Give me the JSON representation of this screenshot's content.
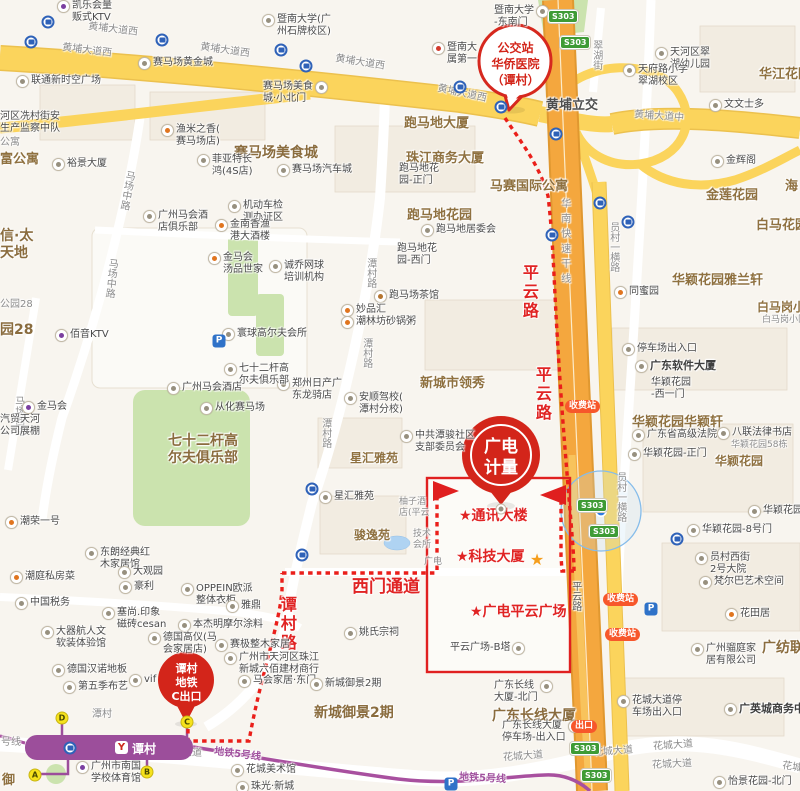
{
  "colors": {
    "route_red": "#EA1F1A",
    "box_red": "#E02020",
    "balloon_red": "#D3251A",
    "road_yellow": "#FBD45C",
    "highway_orange": "#F4A73E",
    "metro_purple": "#9C4E9B",
    "green": "#CBE3AE",
    "exit_yellow": "#F6E21C",
    "shield_green": "#3E9B35",
    "pill_orange": "#F7572B",
    "bus_blue": "#2F62B8",
    "location_blue": "#2E7BE0"
  },
  "callouts": {
    "bus": {
      "lines": [
        "公交站",
        "华侨医院",
        "（谭村）"
      ]
    },
    "dest": {
      "lines": [
        "广电",
        "计量"
      ]
    },
    "exit": {
      "lines": [
        "谭村",
        "地铁",
        "C出口"
      ]
    }
  },
  "station": {
    "name": "谭村",
    "logo": "Y"
  },
  "map": {
    "labels": [
      {
        "t": "黄埔大道西",
        "x": 88,
        "y": 24,
        "c": "road",
        "rot": 7
      },
      {
        "t": "黄埔大道西",
        "x": 62,
        "y": 45,
        "c": "road",
        "rot": 7
      },
      {
        "t": "黄埔大道西",
        "x": 200,
        "y": 45,
        "c": "road",
        "rot": 8
      },
      {
        "t": "黄埔大道西",
        "x": 335,
        "y": 57,
        "c": "road",
        "rot": 9
      },
      {
        "t": "黄埔大道西",
        "x": 437,
        "y": 88,
        "c": "road",
        "rot": 12
      },
      {
        "t": "黄埔大道中",
        "x": 634,
        "y": 111,
        "c": "road",
        "rot": 4
      },
      {
        "t": "黄埔立交",
        "x": 546,
        "y": 98,
        "c": "roadb"
      },
      {
        "t": "翠湖街",
        "x": 590,
        "y": 40,
        "c": "road",
        "v": 1
      },
      {
        "t": "华南快速干线",
        "x": 558,
        "y": 198,
        "c": "road vsp",
        "v": 1
      },
      {
        "t": "员村一横路",
        "x": 607,
        "y": 222,
        "c": "road",
        "v": 1
      },
      {
        "t": "员村一横路",
        "x": 614,
        "y": 472,
        "c": "road",
        "v": 1
      },
      {
        "t": "潭村路",
        "x": 364,
        "y": 258,
        "c": "road",
        "v": 1
      },
      {
        "t": "潭村路",
        "x": 360,
        "y": 338,
        "c": "road",
        "v": 1
      },
      {
        "t": "潭村路",
        "x": 319,
        "y": 418,
        "c": "road",
        "v": 1
      },
      {
        "t": "马场中路",
        "x": 120,
        "y": 170,
        "c": "road",
        "v": 1,
        "rot": 10
      },
      {
        "t": "马场中路",
        "x": 104,
        "y": 258,
        "c": "road",
        "v": 1,
        "rot": 6
      },
      {
        "t": "马场西路",
        "x": 12,
        "y": 396,
        "c": "road",
        "v": 1
      },
      {
        "t": "平云路",
        "x": 569,
        "y": 581,
        "c": "roaddk",
        "v": 1
      },
      {
        "t": "花城大道",
        "x": 162,
        "y": 747,
        "c": "road",
        "rot": 3
      },
      {
        "t": "花城大道",
        "x": 503,
        "y": 751,
        "c": "road",
        "rot": -4
      },
      {
        "t": "花城大道",
        "x": 593,
        "y": 746,
        "c": "road",
        "rot": -4
      },
      {
        "t": "花城大道",
        "x": 653,
        "y": 740,
        "c": "road",
        "rot": -4
      },
      {
        "t": "花城大道",
        "x": 652,
        "y": 759,
        "c": "road",
        "rot": -3
      },
      {
        "t": "花城大道",
        "x": 782,
        "y": 763,
        "c": "road",
        "rot": 8
      },
      {
        "t": "地铁5号线",
        "x": 214,
        "y": 749,
        "c": "purple",
        "rot": 7
      },
      {
        "t": "地铁5号线",
        "x": 459,
        "y": 773,
        "c": "purple",
        "rot": 3
      },
      {
        "t": "号线",
        "x": 1,
        "y": 737,
        "c": "road"
      },
      {
        "t": "潭村",
        "x": 92,
        "y": 709,
        "c": "g"
      },
      {
        "t": "平云路",
        "x": 519,
        "y": 264,
        "c": "red16",
        "v": 1
      },
      {
        "t": "平云路",
        "x": 532,
        "y": 366,
        "c": "red16",
        "v": 1
      },
      {
        "t": "谭村路",
        "x": 277,
        "y": 596,
        "c": "red16",
        "v": 1
      },
      {
        "t": "西门通道",
        "x": 352,
        "y": 577,
        "c": "red17"
      },
      {
        "t": "★通讯大楼",
        "x": 459,
        "y": 508,
        "c": "red15"
      },
      {
        "t": "★科技大厦",
        "x": 456,
        "y": 549,
        "c": "red15"
      },
      {
        "t": "★广电平云广场",
        "x": 470,
        "y": 604,
        "c": "red15"
      },
      {
        "t": "赛马场美食城",
        "x": 234,
        "y": 145,
        "c": "a14"
      },
      {
        "t": "跑马地大厦",
        "x": 404,
        "y": 116,
        "c": "a13"
      },
      {
        "t": "珠江商务大厦",
        "x": 406,
        "y": 151,
        "c": "a13"
      },
      {
        "t": "跑马地花园",
        "x": 407,
        "y": 208,
        "c": "a13"
      },
      {
        "t": "马赛国际公寓",
        "x": 490,
        "y": 179,
        "c": "a13"
      },
      {
        "t": "金莲花园",
        "x": 706,
        "y": 188,
        "c": "a13"
      },
      {
        "t": "白马花园",
        "x": 756,
        "y": 218,
        "c": "a13"
      },
      {
        "t": "华江花园",
        "x": 759,
        "y": 67,
        "c": "a13"
      },
      {
        "t": "白马岗小区",
        "x": 757,
        "y": 300,
        "c": "area"
      },
      {
        "t": "白马岗小区",
        "x": 762,
        "y": 315,
        "c": "g9"
      },
      {
        "t": "华颖花园雅兰轩",
        "x": 672,
        "y": 273,
        "c": "a13"
      },
      {
        "t": "华颖花园华颖轩",
        "x": 632,
        "y": 415,
        "c": "a13"
      },
      {
        "t": "华颖花园",
        "x": 715,
        "y": 454,
        "c": "area"
      },
      {
        "t": "新城市领秀",
        "x": 420,
        "y": 376,
        "c": "a13"
      },
      {
        "t": "星汇雅苑",
        "x": 350,
        "y": 451,
        "c": "area"
      },
      {
        "t": "骏逸苑",
        "x": 354,
        "y": 528,
        "c": "area"
      },
      {
        "t": "七十二杆高\n尔夫俱乐部",
        "x": 168,
        "y": 433,
        "c": "a14"
      },
      {
        "t": "新城御景2期",
        "x": 314,
        "y": 705,
        "c": "a14"
      },
      {
        "t": "广东长线大厦",
        "x": 492,
        "y": 708,
        "c": "a14"
      },
      {
        "t": "富公寓",
        "x": 0,
        "y": 152,
        "c": "a13"
      },
      {
        "t": "信·太\n天地",
        "x": 0,
        "y": 228,
        "c": "a14"
      },
      {
        "t": "园28",
        "x": 0,
        "y": 322,
        "c": "a14"
      },
      {
        "t": "公园28",
        "x": 0,
        "y": 299,
        "c": "g"
      },
      {
        "t": "海",
        "x": 785,
        "y": 179,
        "c": "a13"
      },
      {
        "t": "广纺联",
        "x": 762,
        "y": 640,
        "c": "a14"
      },
      {
        "t": "公寓",
        "x": 0,
        "y": 137,
        "c": "g"
      },
      {
        "t": "御",
        "x": 2,
        "y": 773,
        "c": "a13"
      },
      {
        "t": "凯乐会量\n贩式KTV",
        "x": 57,
        "y": 0,
        "i": "#7B3FA0"
      },
      {
        "t": "联通新时空广场",
        "x": 16,
        "y": 75,
        "i": 1
      },
      {
        "t": "裕景大厦",
        "x": 52,
        "y": 158,
        "i": 1
      },
      {
        "t": "赛马场黄金城",
        "x": 138,
        "y": 57,
        "i": 1
      },
      {
        "t": "渔米之香(\n赛马场店)",
        "x": 161,
        "y": 124,
        "i": "#E0751F"
      },
      {
        "t": "菲亚特长\n鸿(4S店)",
        "x": 197,
        "y": 154,
        "i": 1
      },
      {
        "t": "赛马场汽车城",
        "x": 277,
        "y": 164,
        "i": 1
      },
      {
        "t": "赛马场美食\n城·小北门",
        "x": 263,
        "y": 81,
        "ir": 1
      },
      {
        "t": "暨南大学(广\n州石牌校区)",
        "x": 262,
        "y": 14,
        "i": 1
      },
      {
        "t": "暨南大学\n-东南门",
        "x": 494,
        "y": 5,
        "ir": 1
      },
      {
        "t": "暨南大\n属第一",
        "x": 432,
        "y": 42,
        "i": "#D33A2C"
      },
      {
        "t": "河区冼村街安\n生产监察中队",
        "x": 0,
        "y": 111
      },
      {
        "t": "机动车检\n测办证区",
        "x": 228,
        "y": 200,
        "i": 1
      },
      {
        "t": "金南香渔\n港大酒楼",
        "x": 215,
        "y": 219,
        "i": "#E0751F"
      },
      {
        "t": "金马会\n汤品世家",
        "x": 208,
        "y": 252,
        "i": "#E0751F"
      },
      {
        "t": "诚乔网球\n培训机构",
        "x": 269,
        "y": 260,
        "i": 1
      },
      {
        "t": "广州马会酒\n店俱乐部",
        "x": 143,
        "y": 210,
        "i": 1
      },
      {
        "t": "天河区翠\n湖幼儿园",
        "x": 655,
        "y": 47,
        "i": 1
      },
      {
        "t": "天府路小学\n翠湖校区",
        "x": 623,
        "y": 64,
        "i": 1
      },
      {
        "t": "文文士多",
        "x": 709,
        "y": 99,
        "i": 1
      },
      {
        "t": "金辉阁",
        "x": 711,
        "y": 155,
        "i": 1
      },
      {
        "t": "同蜜园",
        "x": 614,
        "y": 286,
        "i": "#E0751F"
      },
      {
        "t": "跑马地居委会",
        "x": 421,
        "y": 224,
        "i": 1
      },
      {
        "t": "跑马地花\n园-西门",
        "x": 397,
        "y": 243
      },
      {
        "t": "跑马地花\n园-正门",
        "x": 399,
        "y": 163
      },
      {
        "t": "跑马场茶馆",
        "x": 374,
        "y": 290,
        "i": "#B5752F"
      },
      {
        "t": "妙品汇",
        "x": 341,
        "y": 304,
        "i": "#E0751F"
      },
      {
        "t": "潮林坊砂锅粥",
        "x": 341,
        "y": 316,
        "i": "#E0751F"
      },
      {
        "t": "郑州日产广\n东龙骑店",
        "x": 277,
        "y": 378,
        "i": 1
      },
      {
        "t": "安顺驾校(\n潭村分校)",
        "x": 344,
        "y": 392,
        "i": 1
      },
      {
        "t": "中共潭骏社区\n支部委员会",
        "x": 400,
        "y": 430,
        "i": 1
      },
      {
        "t": "星汇雅苑",
        "x": 319,
        "y": 491,
        "i": 1
      },
      {
        "t": "柚子酒\n店(平云",
        "x": 399,
        "y": 497,
        "c": "g9"
      },
      {
        "t": "技术\n会所",
        "x": 413,
        "y": 529,
        "c": "g9"
      },
      {
        "t": "广电",
        "x": 424,
        "y": 557,
        "c": "g9"
      },
      {
        "t": "寰球高尔夫会所",
        "x": 222,
        "y": 328,
        "i": 1
      },
      {
        "t": "从化赛马场",
        "x": 200,
        "y": 402,
        "i": 1
      },
      {
        "t": "七十二杆高\n尔夫俱乐部",
        "x": 224,
        "y": 363,
        "i": 1
      },
      {
        "t": "广州马会酒店",
        "x": 167,
        "y": 382,
        "i": 1
      },
      {
        "t": "汽贸天河\n公司展棚",
        "x": 0,
        "y": 414
      },
      {
        "t": "金马会",
        "x": 22,
        "y": 401,
        "i": "#7B3FA0"
      },
      {
        "t": "佰音KTV",
        "x": 55,
        "y": 329,
        "i": "#7B3FA0"
      },
      {
        "t": "潮荣一号",
        "x": 5,
        "y": 516,
        "i": "#E0751F"
      },
      {
        "t": "东朗经典红\n木家居馆",
        "x": 85,
        "y": 547,
        "i": 1
      },
      {
        "t": "大观园",
        "x": 118,
        "y": 566,
        "i": 1
      },
      {
        "t": "豪利",
        "x": 119,
        "y": 581,
        "i": 1
      },
      {
        "t": "潮庭私房菜",
        "x": 10,
        "y": 571,
        "i": "#E0751F"
      },
      {
        "t": "OPPEIN欧派\n整体衣柜",
        "x": 181,
        "y": 583,
        "i": 1
      },
      {
        "t": "雅鼎",
        "x": 226,
        "y": 600,
        "i": 1
      },
      {
        "t": "中国税务",
        "x": 15,
        "y": 597,
        "i": 1
      },
      {
        "t": "塞尚.印象\n磁砖cesan",
        "x": 102,
        "y": 607,
        "i": 1
      },
      {
        "t": "本杰明摩尔涂料",
        "x": 178,
        "y": 619,
        "i": 1
      },
      {
        "t": "大器航人文\n软装体验馆",
        "x": 41,
        "y": 626,
        "i": 1
      },
      {
        "t": "德国高仪(马\n会家居店)",
        "x": 148,
        "y": 632,
        "i": 1
      },
      {
        "t": "赛极整木家居",
        "x": 215,
        "y": 639,
        "i": 1
      },
      {
        "t": "德国汉诺地板",
        "x": 52,
        "y": 664,
        "i": 1
      },
      {
        "t": "vif",
        "x": 129,
        "y": 674,
        "i": 1
      },
      {
        "t": "第五季布艺",
        "x": 63,
        "y": 681,
        "i": 1
      },
      {
        "t": "广州市天河区珠江\n新城六佰建材商行",
        "x": 224,
        "y": 652,
        "i": 1
      },
      {
        "t": "马会家居·东门",
        "x": 238,
        "y": 675,
        "i": 1
      },
      {
        "t": "新城御景2期",
        "x": 310,
        "y": 678,
        "i": 1
      },
      {
        "t": "姚氏宗祠",
        "x": 344,
        "y": 627,
        "i": 1
      },
      {
        "t": "广州市南国\n学校体育馆",
        "x": 76,
        "y": 761,
        "i": "#7B3FA0"
      },
      {
        "t": "花城美术馆",
        "x": 231,
        "y": 764,
        "i": 1
      },
      {
        "t": "珠光·新城",
        "x": 236,
        "y": 781,
        "i": 1
      },
      {
        "t": "平云广场-B塔",
        "x": 450,
        "y": 642,
        "ir": 1
      },
      {
        "t": "广东长线\n大厦-北门",
        "x": 494,
        "y": 680,
        "ir": 1
      },
      {
        "t": "广东长线大厦\n停车场-出入口",
        "x": 502,
        "y": 720,
        "ir": 1
      },
      {
        "t": "花城大道停\n车场出入口",
        "x": 617,
        "y": 695,
        "i": 1
      },
      {
        "t": "广英城商务中心",
        "x": 724,
        "y": 703,
        "c": "pb",
        "i": 1
      },
      {
        "t": "怡景花园-北门",
        "x": 713,
        "y": 776,
        "i": 1
      },
      {
        "t": "广州骝庭家\n居有限公司",
        "x": 691,
        "y": 643,
        "i": 1
      },
      {
        "t": "花田居",
        "x": 725,
        "y": 608,
        "i": "#E0751F"
      },
      {
        "t": "梵尔巴艺术空间",
        "x": 699,
        "y": 576,
        "i": 1
      },
      {
        "t": "员村西街\n2号大院",
        "x": 695,
        "y": 552,
        "i": 1
      },
      {
        "t": "华颖花园-8号门",
        "x": 687,
        "y": 524,
        "i": 1
      },
      {
        "t": "华颖花园",
        "x": 748,
        "y": 505,
        "i": 1
      },
      {
        "t": "华颖花园-正门",
        "x": 628,
        "y": 448,
        "i": 1
      },
      {
        "t": "广东省高级法院",
        "x": 632,
        "y": 429,
        "i": 1
      },
      {
        "t": "八联法律书店",
        "x": 717,
        "y": 427,
        "i": 1
      },
      {
        "t": "华颖花园58栋",
        "x": 731,
        "y": 440,
        "c": "g9"
      },
      {
        "t": "广东软件大厦",
        "x": 635,
        "y": 360,
        "c": "pb",
        "i": 1
      },
      {
        "t": "停车场出入口",
        "x": 622,
        "y": 343,
        "i": 1
      },
      {
        "t": "华颖花园\n-西一门",
        "x": 651,
        "y": 377
      }
    ],
    "icons": [
      {
        "k": "bus",
        "x": 48,
        "y": 22
      },
      {
        "k": "bus",
        "x": 31,
        "y": 42
      },
      {
        "k": "bus",
        "x": 162,
        "y": 40
      },
      {
        "k": "bus",
        "x": 281,
        "y": 50
      },
      {
        "k": "bus",
        "x": 306,
        "y": 66
      },
      {
        "k": "bus",
        "x": 460,
        "y": 87
      },
      {
        "k": "bus",
        "x": 501,
        "y": 107
      },
      {
        "k": "bus",
        "x": 556,
        "y": 134
      },
      {
        "k": "bus",
        "x": 600,
        "y": 203
      },
      {
        "k": "bus",
        "x": 628,
        "y": 222
      },
      {
        "k": "bus",
        "x": 552,
        "y": 235
      },
      {
        "k": "bus",
        "x": 312,
        "y": 489
      },
      {
        "k": "bus",
        "x": 302,
        "y": 555
      },
      {
        "k": "bus",
        "x": 677,
        "y": 539
      },
      {
        "k": "bus",
        "x": 70,
        "y": 748
      },
      {
        "k": "p",
        "t": "P",
        "x": 219,
        "y": 341
      },
      {
        "k": "p",
        "t": "P",
        "x": 651,
        "y": 609
      },
      {
        "k": "p",
        "t": "P",
        "x": 451,
        "y": 784
      },
      {
        "k": "exit",
        "t": "A",
        "x": 35,
        "y": 775
      },
      {
        "k": "exit",
        "t": "B",
        "x": 147,
        "y": 772
      },
      {
        "k": "exit",
        "t": "C",
        "x": 187,
        "y": 722
      },
      {
        "k": "exit",
        "t": "D",
        "x": 62,
        "y": 718
      },
      {
        "k": "shield",
        "t": "S303",
        "x": 548,
        "y": 10
      },
      {
        "k": "shield",
        "t": "S303",
        "x": 560,
        "y": 36
      },
      {
        "k": "shield",
        "t": "S303",
        "x": 577,
        "y": 499
      },
      {
        "k": "shield",
        "t": "S303",
        "x": 589,
        "y": 525
      },
      {
        "k": "shield",
        "t": "S303",
        "x": 570,
        "y": 742
      },
      {
        "k": "shield",
        "t": "S303",
        "x": 581,
        "y": 769
      },
      {
        "k": "pill",
        "t": "收费站",
        "x": 565,
        "y": 400
      },
      {
        "k": "pill",
        "t": "收费站",
        "x": 603,
        "y": 593
      },
      {
        "k": "pill",
        "t": "收费站",
        "x": 605,
        "y": 628
      },
      {
        "k": "pill",
        "t": "出口",
        "x": 571,
        "y": 720
      },
      {
        "k": "star",
        "t": "★",
        "x": 537,
        "y": 560
      },
      {
        "k": "poi",
        "x": 501,
        "y": 509
      }
    ]
  }
}
